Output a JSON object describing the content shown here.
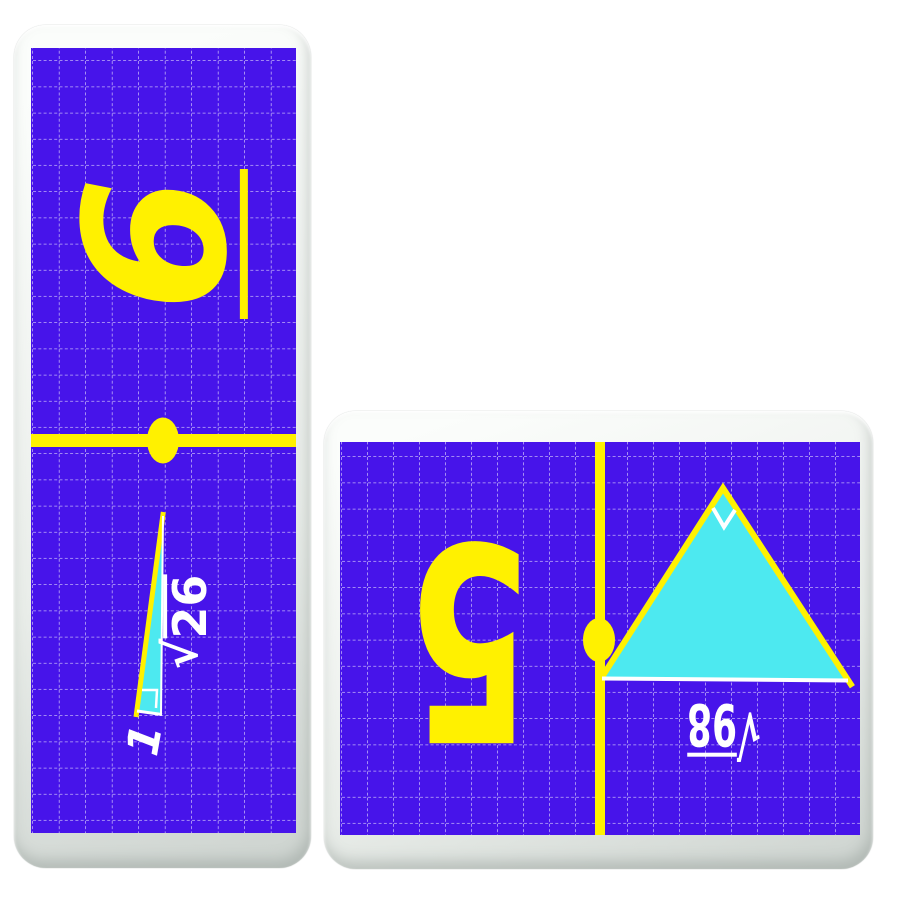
{
  "colors": {
    "page_background": "#ffffff",
    "card_face": "#f0f3f0",
    "card_shadow_edge": "#cfd5d1",
    "board_purple": "#4714ea",
    "accent_yellow": "#fff100",
    "triangle_cyan": "#4de9f0",
    "grid_line_white": "#ffffff",
    "label_white": "#ffffff"
  },
  "left_card": {
    "orientation": "vertical",
    "answer_number": "6",
    "answer_underlined": true,
    "divider": "line-with-dot",
    "triangle_labels": {
      "radical_sign": "√",
      "radicand": "26",
      "leg_label": "1"
    }
  },
  "right_card": {
    "orientation": "horizontal",
    "answer_number": "5",
    "divider": "line-with-dot",
    "triangle_labels": {
      "radical_sign": "√",
      "radicand": "98"
    }
  }
}
